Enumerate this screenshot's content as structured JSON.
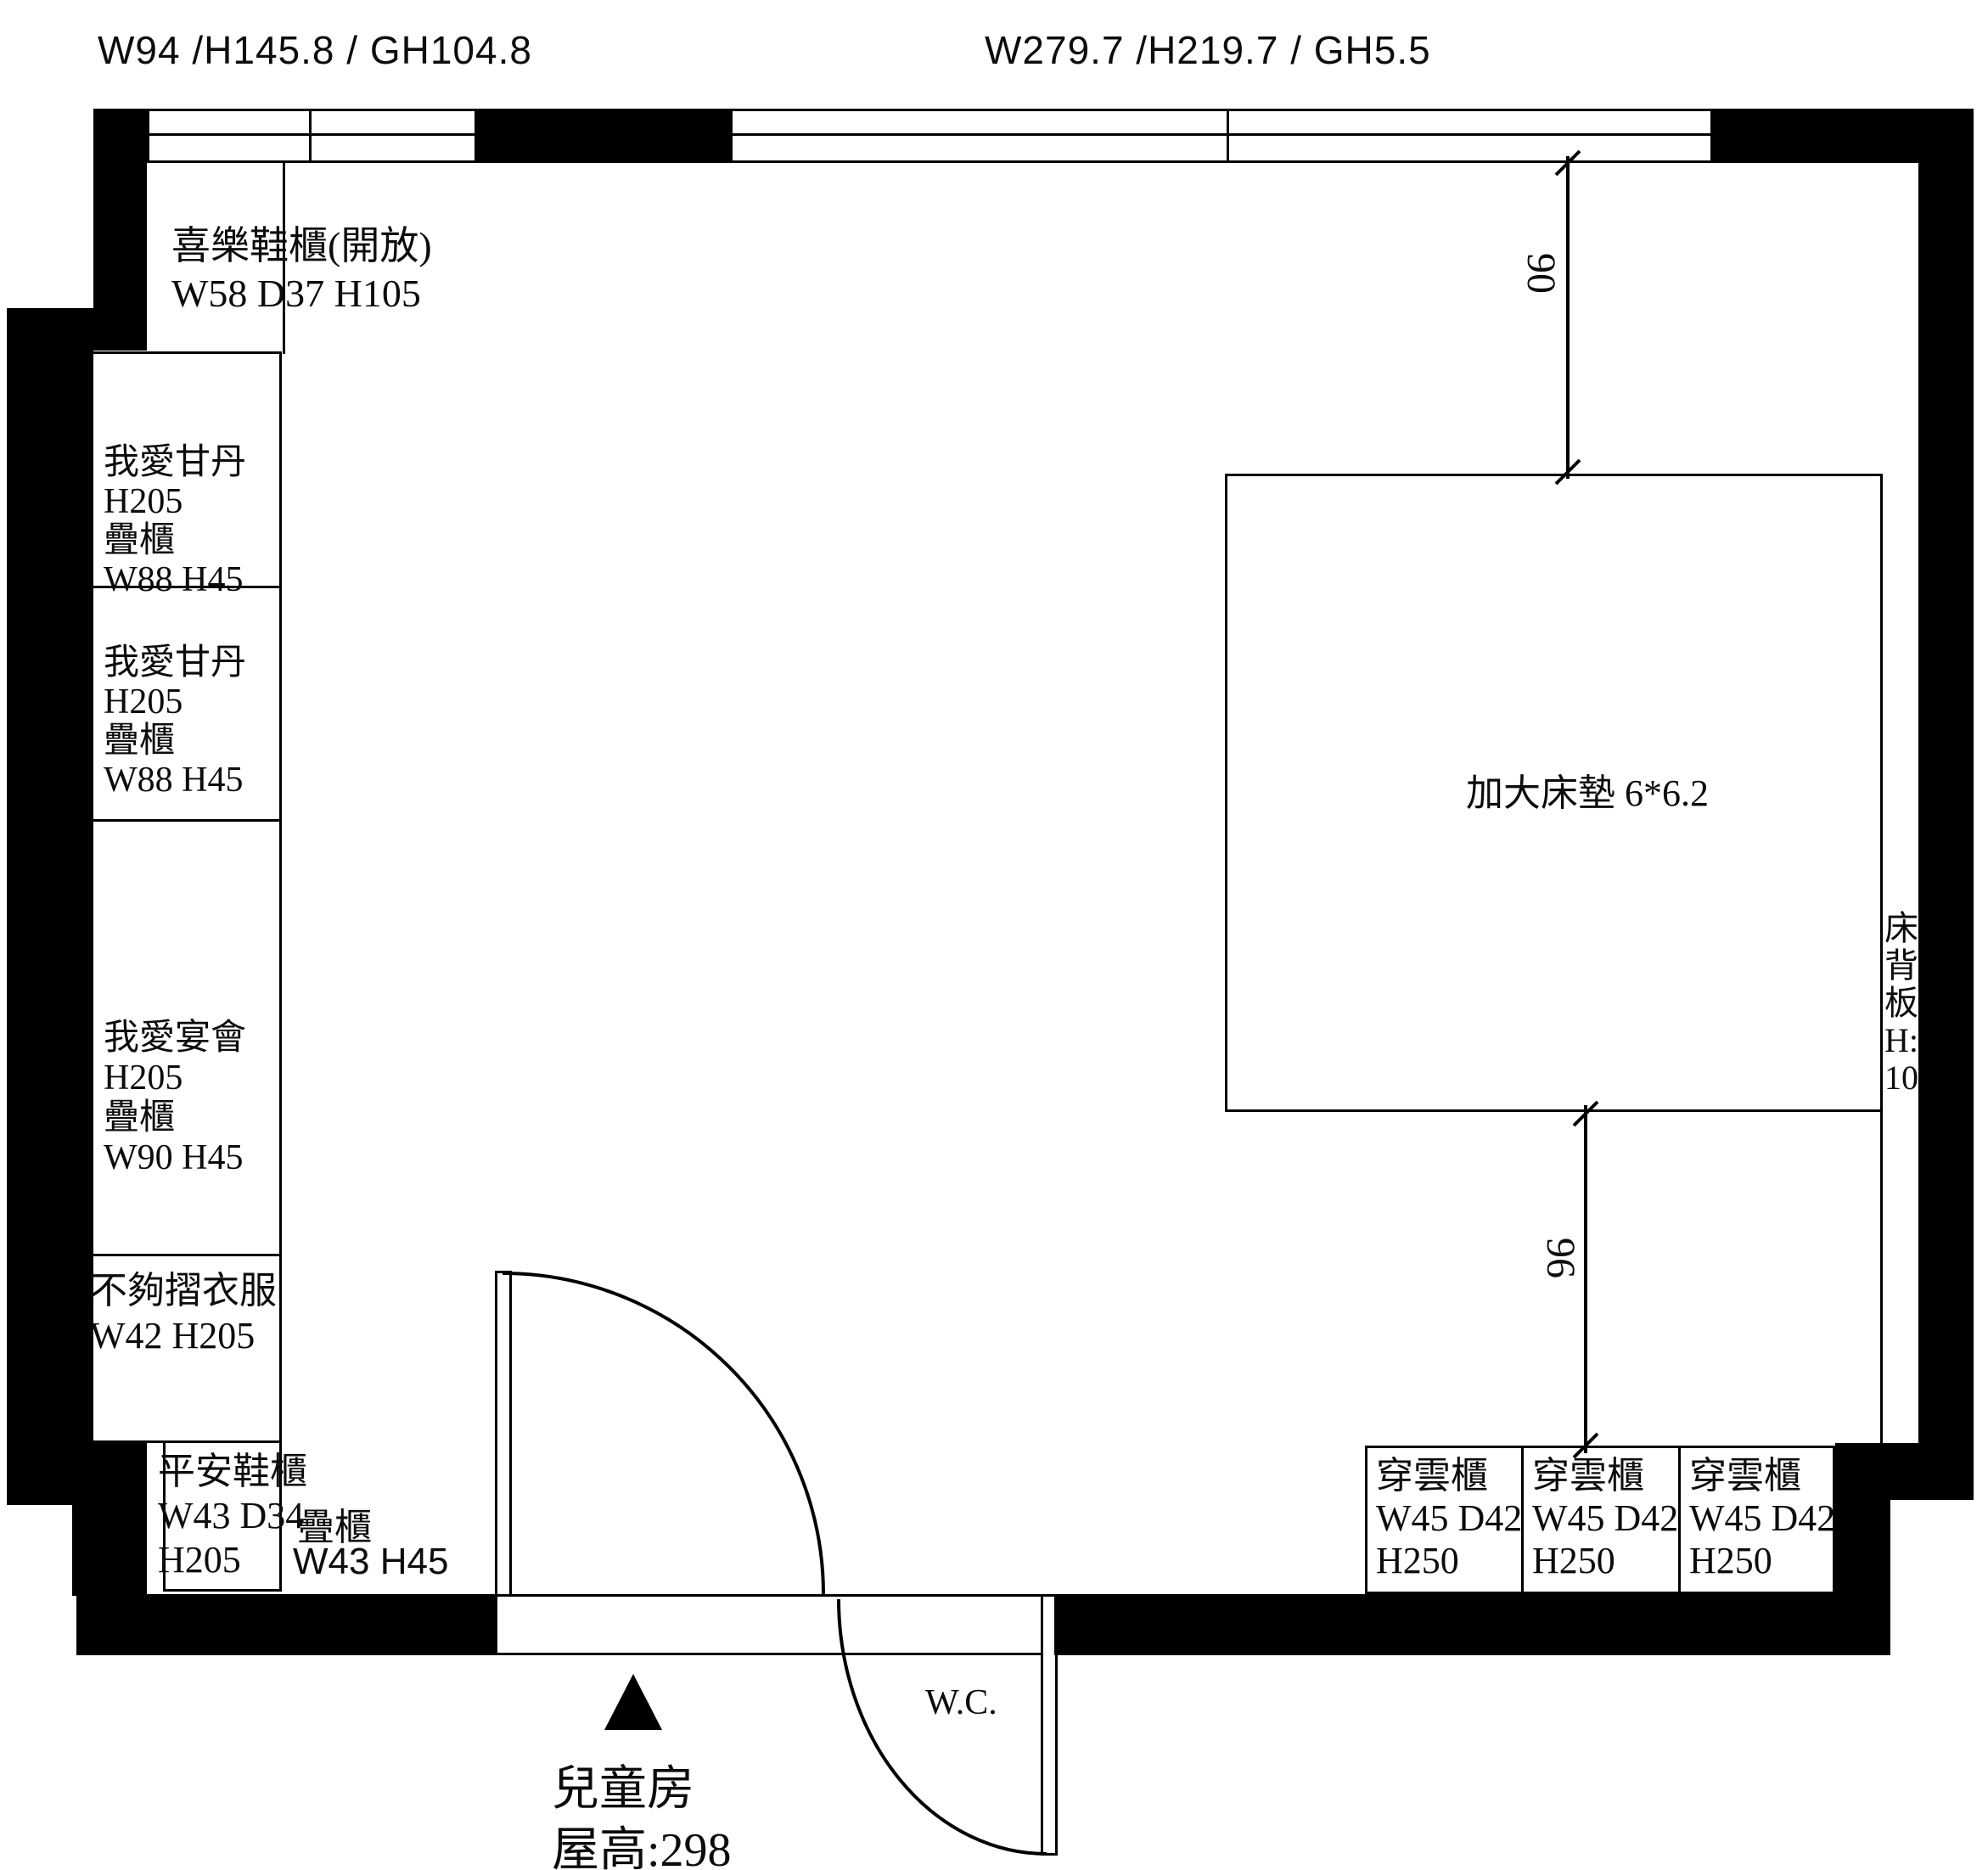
{
  "top_labels": {
    "left": "W94 /H145.8 / GH104.8",
    "center": "W279.7 /H219.7 / GH5.5"
  },
  "shoe_cabinet_open": {
    "line1": "喜樂鞋櫃(開放)",
    "line2": "W58 D37 H105"
  },
  "left_cabinets": [
    {
      "lines": [
        "我愛甘丹",
        "H205",
        "疊櫃",
        "W88 H45"
      ]
    },
    {
      "lines": [
        "我愛甘丹",
        "H205",
        "疊櫃",
        "W88 H45"
      ]
    },
    {
      "lines": [
        "我愛宴會",
        "H205",
        "疊櫃",
        "W90 H45"
      ]
    },
    {
      "lines": [
        "不夠摺衣服",
        "W42 H205"
      ]
    },
    {
      "lines": [
        "平安鞋櫃",
        "W43 D34",
        "H205"
      ]
    }
  ],
  "stack_cabinet": {
    "name": "疊櫃",
    "dims": "W43 H45"
  },
  "wardrobes": [
    {
      "name": "穿雲櫃",
      "dims": "W45 D42.5",
      "height": "H250"
    },
    {
      "name": "穿雲櫃",
      "dims": "W45 D42.5",
      "height": "H250"
    },
    {
      "name": "穿雲櫃",
      "dims": "W45 D42.5",
      "height": "H250"
    }
  ],
  "bed": {
    "label": "加大床墊 6*6.2"
  },
  "headboard": {
    "lines": [
      "床",
      "背",
      "板",
      "H:",
      "100"
    ]
  },
  "dimensions": {
    "d1": "90",
    "d2": "96"
  },
  "wc_label": "W.C.",
  "room": {
    "name": "兒童房",
    "ceiling": "屋高:298"
  },
  "colors": {
    "ink": "#000000",
    "paper": "#ffffff"
  }
}
